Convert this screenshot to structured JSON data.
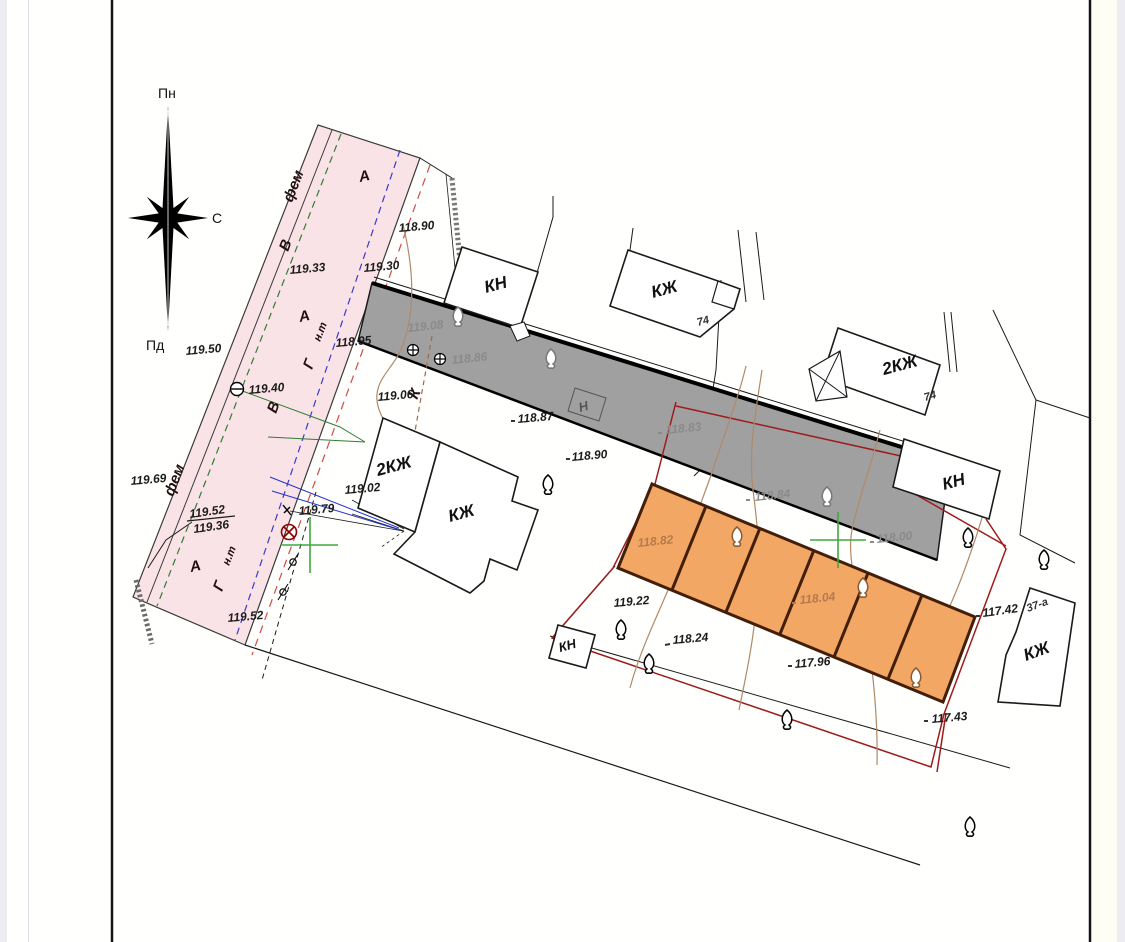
{
  "colors": {
    "road_fill": "#FAE3E7",
    "strip_fill": "#A0A0A0",
    "garage_fill": "#F2A765",
    "garage_border": "#431F0A",
    "boundary_red": "#9E1B1B",
    "dashed_red": "#D24A43",
    "water_green": "#2F7D32",
    "gas_blue": "#3A3ACD",
    "grid_green": "#3FA93F",
    "contour_brown": "#B08968",
    "gray_text": "#8A8A8A",
    "orange_text": "#B5794F"
  },
  "compass": {
    "north": "Пн",
    "east": "С",
    "south": "Пд"
  },
  "road": {
    "surface_top": "фем",
    "surface_left": "фем",
    "zone_a_top": "А",
    "zone_a_mid": "А",
    "zone_a_bottom": "А",
    "water_mark_top": "В",
    "water_mark_bottom": "В",
    "gas_mark_top": "Г",
    "gas_pressure_top": "н.т",
    "gas_mark_bottom": "Г",
    "gas_pressure_bottom": "н.т"
  },
  "utilities": {
    "cable_mark": "К",
    "shed_mark": "Н"
  },
  "buildings": {
    "kn_top": "КН",
    "kzh_74": "КЖ",
    "kzh_74_num": "74",
    "kzh2_74": "2КЖ",
    "kzh2_74_num": "74",
    "kn_right": "КН",
    "kzh2_mid": "2КЖ",
    "kzh_mid": "КЖ",
    "kn_small": "КН",
    "kzh_37a": "КЖ",
    "kzh_37a_num": "37-а"
  },
  "elevations": {
    "e119_50": "119.50",
    "e119_40": "119.40",
    "e119_33": "119.33",
    "e119_30": "119.30",
    "e118_90_top": "118.90",
    "e118_95": "118.95",
    "e119_08": "119.08",
    "e118_86": "118.86",
    "e119_06": "119.06",
    "e118_87": "118.87",
    "e118_90_mid": "118.90",
    "e118_83": "118.83",
    "e119_69": "119.69",
    "e119_52_upper": "119.52",
    "e119_36": "119.36",
    "e119_79": "119.79",
    "e119_02": "119.02",
    "e119_52_lower": "119.52",
    "e119_22": "119.22",
    "e118_82": "118.82",
    "e118_84": "118.84",
    "e118_00": "118.00",
    "e118_24": "118.24",
    "e118_04": "118.04",
    "e117_96": "117.96",
    "e117_42": "117.42",
    "e117_43": "117.43"
  }
}
